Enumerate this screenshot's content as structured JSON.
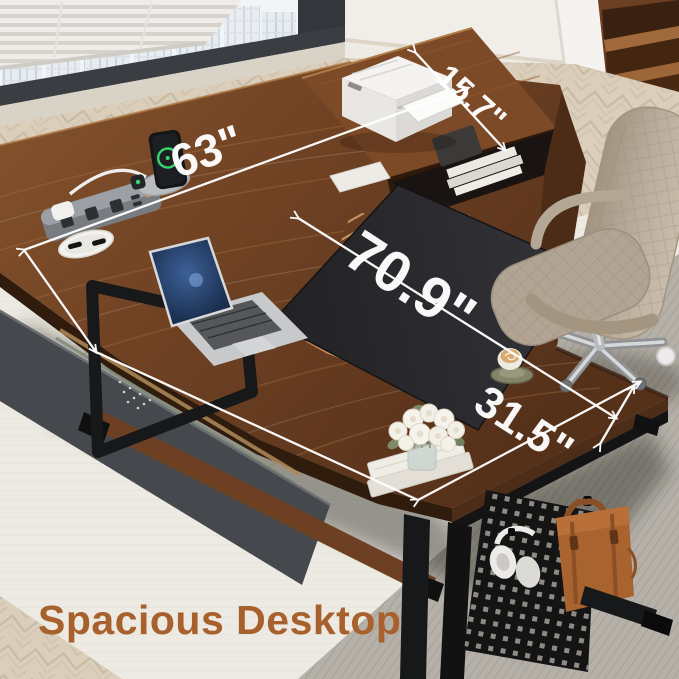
{
  "caption": {
    "text": "Spacious Desktop",
    "color": "#A8612C"
  },
  "dimension_labels": {
    "desk_length_top": "63\"",
    "hutch_shelf_depth": "15.7\"",
    "desktop_total_length": "70.9\"",
    "return_desk_depth": "31.5\""
  },
  "objects": {
    "printer": "white printer",
    "laptop": "silver laptop",
    "desk_mat": "black desk mat",
    "power_strip": "recessed power strip",
    "charging_dock": "phone and watch charging dock",
    "cable_grommet": "cable grommet",
    "coffee_cup": "latte cup on saucer",
    "flowers": "white roses in glass vase",
    "books": "stacked books",
    "file_cabinet": "chevron two-drawer cabinet",
    "hutch_shelf": "raised storage shelf",
    "pegboard": "side pegboard panel",
    "headphones": "white headphones",
    "leather_bag": "brown leather briefcase",
    "office_chair": "taupe executive chair",
    "window": "city-view window with blinds",
    "bookshelf": "corner bookshelf",
    "rug": "ivory area rug",
    "carpet": "grey office carpet",
    "floor": "herringbone wood floor"
  },
  "colors": {
    "caption_text": "#A8612C",
    "desk_wood": "#6F4023",
    "desk_mat": "#26262A",
    "frame_black": "#161616",
    "chair_upholstery": "#B5A897",
    "rug": "#ECEAE2",
    "carpet": "#B5B1A9",
    "floor_wood": "#DCCFBC",
    "drawer_inlay": "#D09A66",
    "bag_leather": "#A8632F",
    "dimension_line": "#FFFFFF"
  }
}
